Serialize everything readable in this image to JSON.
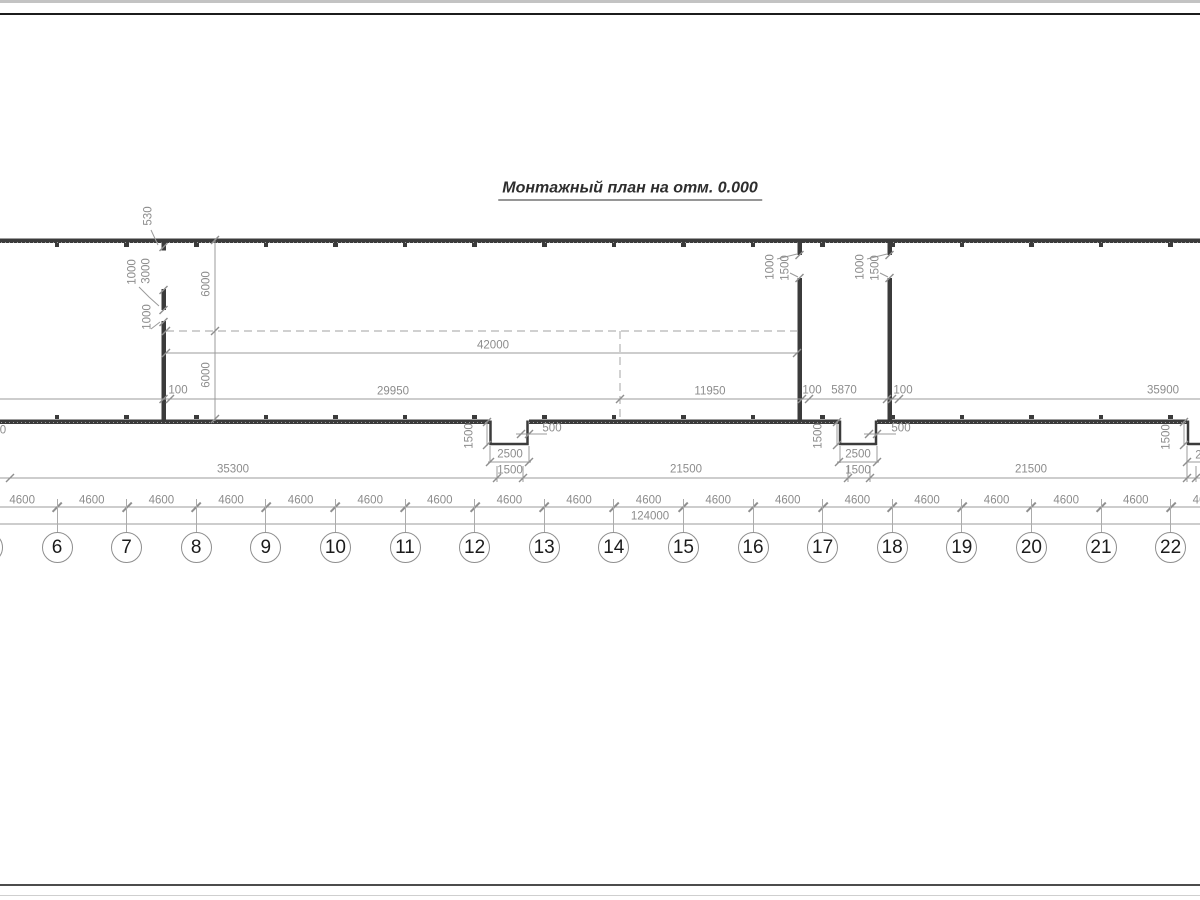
{
  "title": "Монтажный план на отм. 0.000",
  "colors": {
    "wall": "#3b3b3b",
    "dim_line": "#9b9b9b",
    "dim_text": "#8c8c8c",
    "axis_text": "#1b1b1b"
  },
  "grid_axes": {
    "numbers": [
      "6",
      "7",
      "8",
      "9",
      "10",
      "11",
      "12",
      "13",
      "14",
      "15",
      "16",
      "17",
      "18",
      "19",
      "20",
      "21",
      "22"
    ],
    "start_x": 57,
    "spacing": 69.6,
    "circle_y": 547,
    "bay_label": "4600",
    "bay_label_y": 501,
    "bay_count": 18,
    "partial_left_circle": true
  },
  "dim_labels": [
    {
      "text": "530",
      "x": 149,
      "y": 216,
      "rot": true
    },
    {
      "text": "1000",
      "x": 133,
      "y": 272,
      "rot": true
    },
    {
      "text": "3000",
      "x": 147,
      "y": 271,
      "rot": true
    },
    {
      "text": "1000",
      "x": 148,
      "y": 317,
      "rot": true
    },
    {
      "text": "6000",
      "x": 207,
      "y": 284,
      "rot": true
    },
    {
      "text": "6000",
      "x": 207,
      "y": 375,
      "rot": true
    },
    {
      "text": "1000",
      "x": 771,
      "y": 267,
      "rot": true
    },
    {
      "text": "1500",
      "x": 786,
      "y": 268,
      "rot": true
    },
    {
      "text": "1000",
      "x": 861,
      "y": 267,
      "rot": true
    },
    {
      "text": "1500",
      "x": 876,
      "y": 268,
      "rot": true
    },
    {
      "text": "42000",
      "x": 493,
      "y": 346
    },
    {
      "text": "29950",
      "x": 393,
      "y": 392
    },
    {
      "text": "100",
      "x": 178,
      "y": 391
    },
    {
      "text": "11950",
      "x": 710,
      "y": 392
    },
    {
      "text": "100",
      "x": 812,
      "y": 391
    },
    {
      "text": "5870",
      "x": 844,
      "y": 391
    },
    {
      "text": "100",
      "x": 903,
      "y": 391
    },
    {
      "text": "35900",
      "x": 1163,
      "y": 391
    },
    {
      "text": "1500",
      "x": 470,
      "y": 436,
      "rot": true
    },
    {
      "text": "500",
      "x": 552,
      "y": 429
    },
    {
      "text": "2500",
      "x": 510,
      "y": 455
    },
    {
      "text": "1500",
      "x": 510,
      "y": 471
    },
    {
      "text": "1500",
      "x": 819,
      "y": 436,
      "rot": true
    },
    {
      "text": "500",
      "x": 901,
      "y": 429
    },
    {
      "text": "2500",
      "x": 858,
      "y": 455
    },
    {
      "text": "1500",
      "x": 858,
      "y": 471
    },
    {
      "text": "1500",
      "x": 1167,
      "y": 437,
      "rot": true
    },
    {
      "text": "2500",
      "x": 1208,
      "y": 456
    },
    {
      "text": "35300",
      "x": 233,
      "y": 470
    },
    {
      "text": "21500",
      "x": 686,
      "y": 470
    },
    {
      "text": "21500",
      "x": 1031,
      "y": 470
    },
    {
      "text": "124000",
      "x": 650,
      "y": 517
    },
    {
      "text": "0",
      "x": 3,
      "y": 431
    }
  ]
}
